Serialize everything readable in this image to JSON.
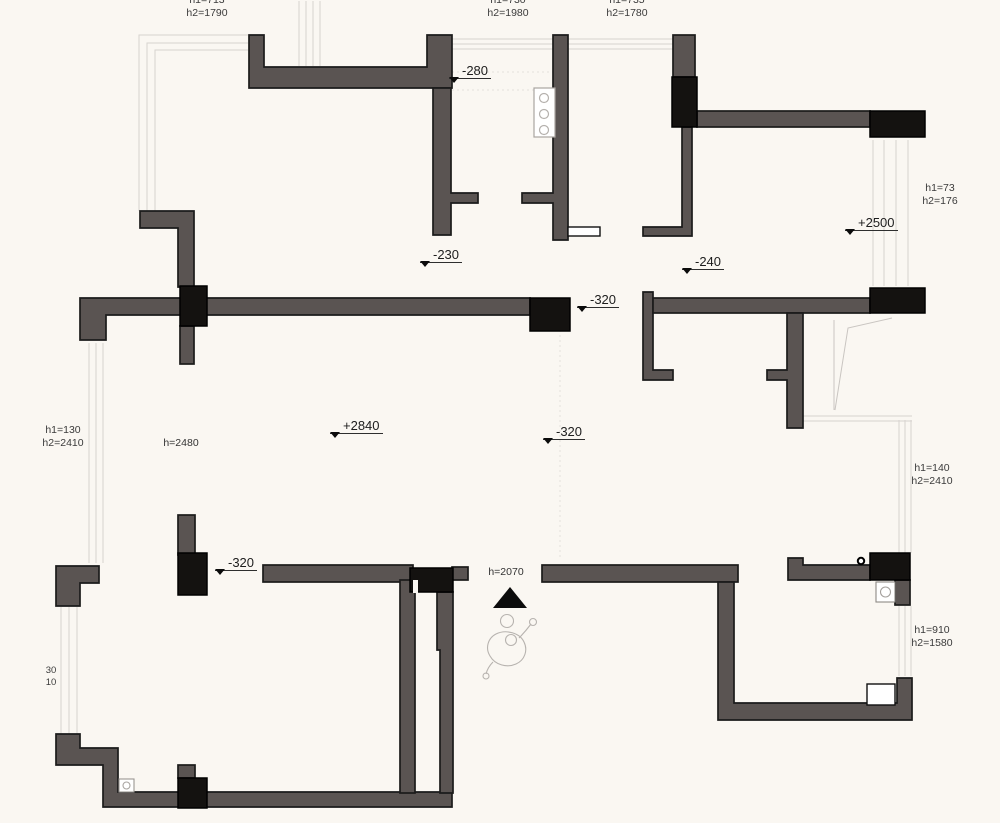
{
  "drawing_type": "apartment floor plan (structural walls / ceiling heights)",
  "colors": {
    "background": "#faf7f2",
    "wall": "#5a5452",
    "column": "#141210",
    "outline": "#1b1b1b",
    "window_line": "#d7d3cf"
  },
  "labels": {
    "top_left": {
      "l1": "h1=713",
      "l2": "h2=1790"
    },
    "top_mid": {
      "l1": "h1=730",
      "l2": "h2=1980"
    },
    "top_right": {
      "l1": "h1=735",
      "l2": "h2=1780"
    },
    "right_upper": {
      "l1": "h1=73",
      "l2": "h2=176"
    },
    "left_mid": {
      "l1": "h1=130",
      "l2": "h2=2410"
    },
    "right_mid": {
      "l1": "h1=140",
      "l2": "h2=2410"
    },
    "right_lower": {
      "l1": "h1=910",
      "l2": "h2=1580"
    },
    "left_bottom": {
      "l1": "30",
      "l2": "10"
    },
    "living": {
      "text": "h=2480"
    },
    "entry_door": {
      "text": "h=2070"
    }
  },
  "elevations": {
    "kitchen": "-280",
    "hall_top": "-230",
    "bed_right": "-240",
    "hall_mid": "-320",
    "living": "+2840",
    "living_right": "-320",
    "balcony_right": "+2500",
    "living_left": "-320"
  }
}
